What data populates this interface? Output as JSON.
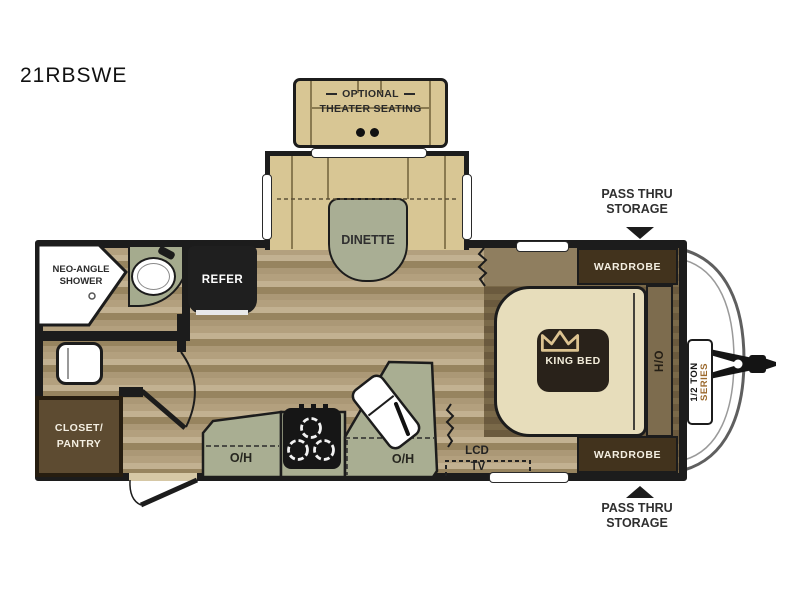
{
  "title": "21RBSWE",
  "optional_seating": {
    "line1": "OPTIONAL",
    "line2": "THEATER SEATING"
  },
  "dinette": {
    "label": "DINETTE"
  },
  "bathroom": {
    "shower_line1": "NEO-ANGLE",
    "shower_line2": "SHOWER"
  },
  "kitchen": {
    "refer": "REFER",
    "oh_left": "O/H",
    "oh_right": "O/H"
  },
  "closet": {
    "line1": "CLOSET/",
    "line2": "PANTRY"
  },
  "bedroom": {
    "king_bed": "KING BED",
    "wardrobe_top": "WARDROBE",
    "wardrobe_bottom": "WARDROBE",
    "ho": "H/O"
  },
  "entertainment": {
    "lcd": "LCD",
    "tv": "TV"
  },
  "storage_top": {
    "line1": "PASS THRU",
    "line2": "STORAGE"
  },
  "storage_bottom": {
    "line1": "PASS THRU",
    "line2": "STORAGE"
  },
  "badge": {
    "line1": "1/2 TON",
    "line2": "SERIES"
  },
  "colors": {
    "wall": "#1c1c1c",
    "floor_light": "#b3a07e",
    "counter_green": "#a9ae92",
    "bench_tan": "#d8c694",
    "bed_cream": "#e7ddbb",
    "cabinet_dark": "#42331d",
    "platform_brown": "#6b5a3e",
    "badge_series_orange": "#9c6a2e",
    "crown_gold": "#dcc390"
  }
}
